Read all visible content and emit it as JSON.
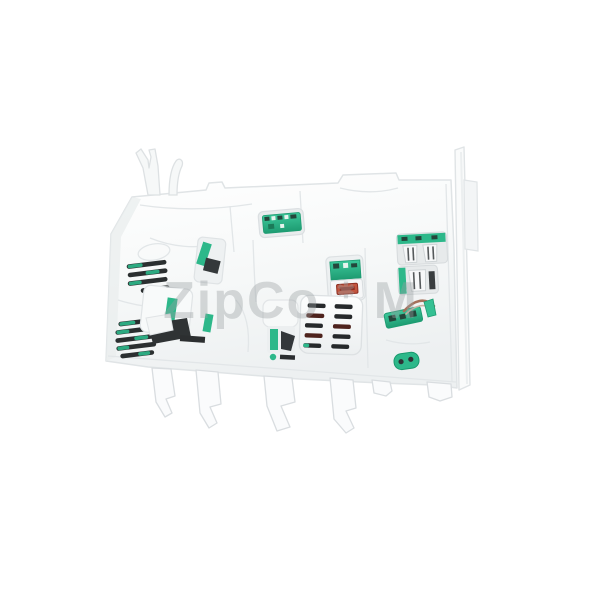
{
  "meta": {
    "subject": "white plastic electronic control module (appliance power/control board) photographed on a plain white background",
    "background_color": "#ffffff"
  },
  "watermark": {
    "part1": "ZipCo",
    "mark": "✱",
    "part2": "M",
    "color": "#a8adaf",
    "opacity": 0.38
  },
  "colors": {
    "plastic_white": "#f7f8f9",
    "plastic_shadow": "#e3e6e8",
    "pcb_green": "#2db88a",
    "pcb_green_dark": "#1e9c72",
    "slot_dark": "#26292b",
    "slot_maroon": "#4e231d",
    "connector_orange": "#c2553f",
    "connector_orange_dark": "#8e2f22",
    "wire_brown": "#a5705a"
  },
  "parts": {
    "housing": "module-housing",
    "top_tabs": [
      "fork-tab",
      "hook-tab"
    ],
    "right_fin": "side-fin",
    "legs_count": 5,
    "vent_groups": 2,
    "pcb_windows": [
      "top-pcb-window",
      "left-pcb-window",
      "orange-connector-window"
    ],
    "grille_slot_rows": 5,
    "grille_slot_cols": 2,
    "right_connectors": 2,
    "wire_board": "wire-pcb",
    "small_component": "green-oval-component"
  }
}
